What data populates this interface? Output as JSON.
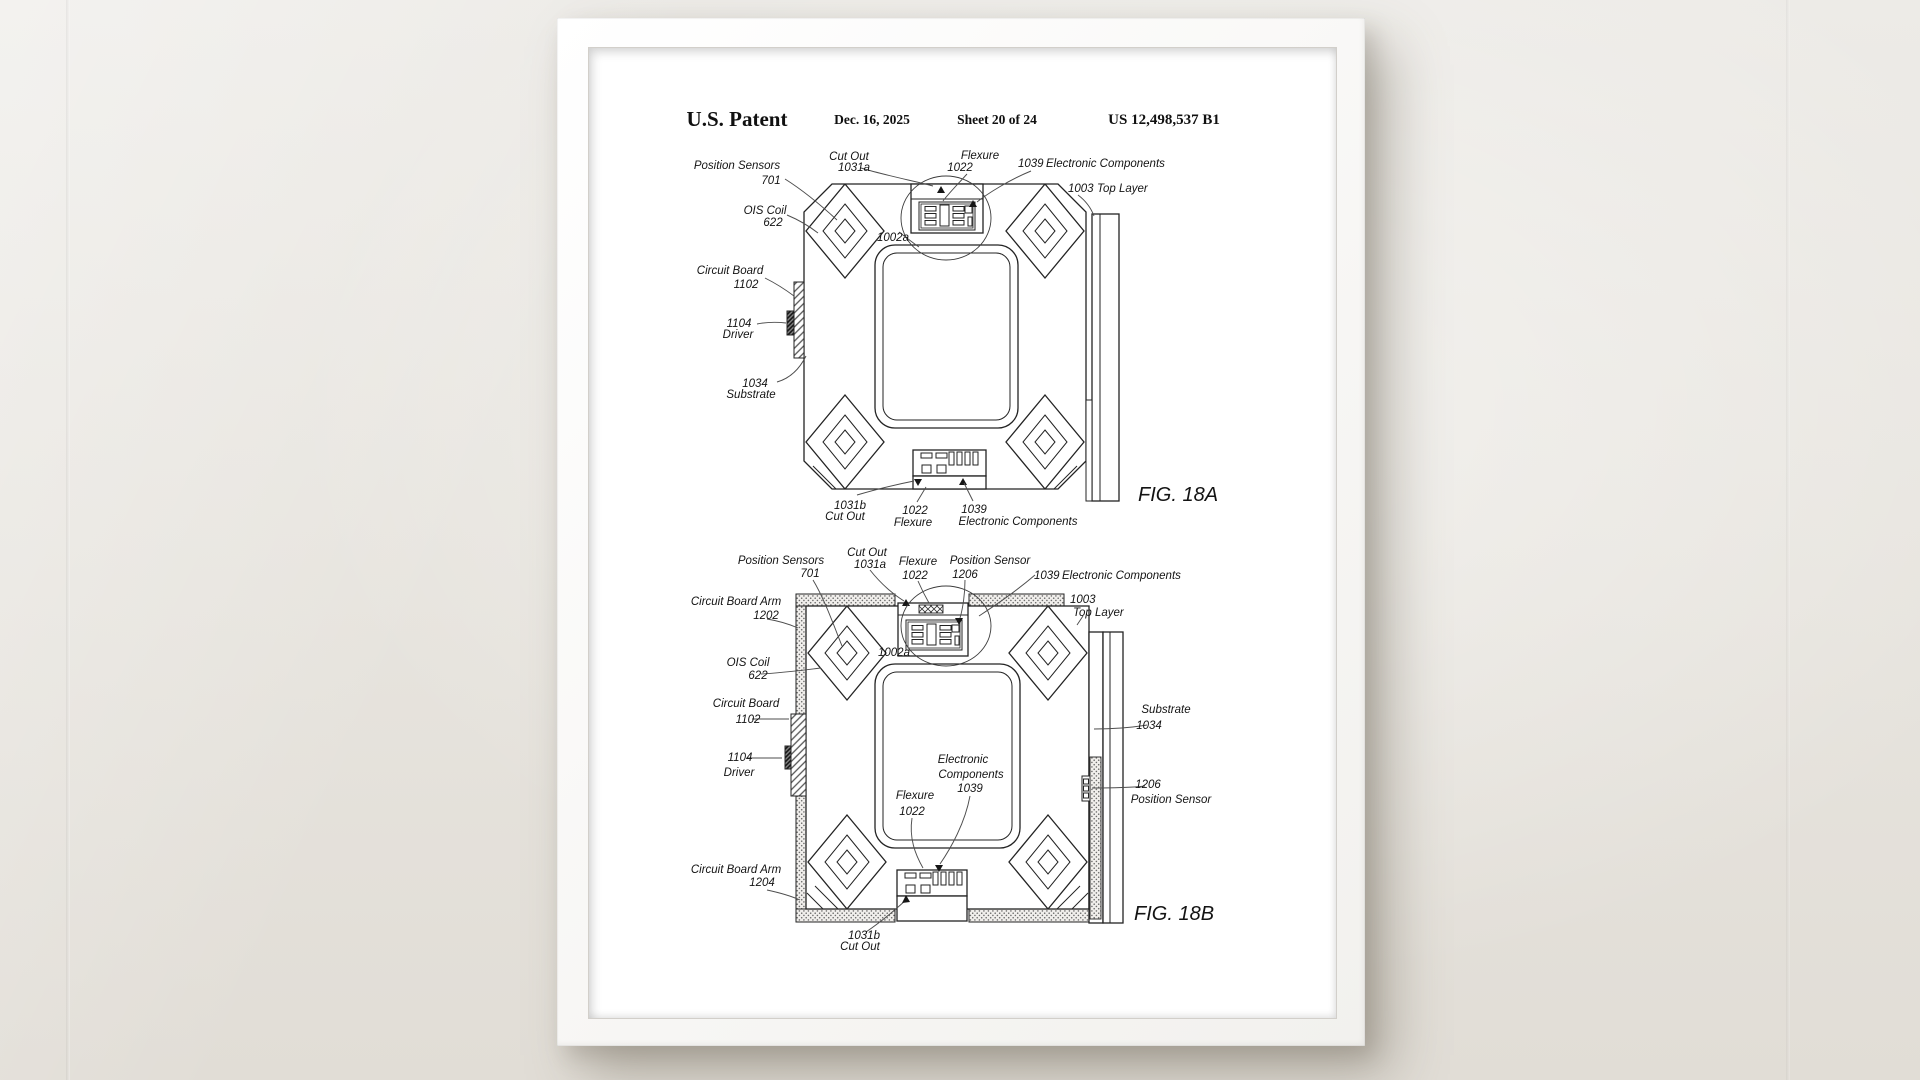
{
  "colors": {
    "wall": "#e8e5e0",
    "frame": "#f7f6f4",
    "paper": "#ffffff",
    "ink": "#141414"
  },
  "header": {
    "title": "U.S. Patent",
    "date": "Dec. 16, 2025",
    "sheet": "Sheet 20 of 24",
    "number": "US 12,498,537 B1"
  },
  "fig18a": {
    "caption": "FIG. 18A",
    "pos_sensors": "Position Sensors",
    "pos_sensors_num": "701",
    "ois_coil": "OIS Coil",
    "ois_coil_num": "622",
    "cut_out_top": "Cut Out",
    "cut_out_top_num": "1031a",
    "flexure_top": "Flexure",
    "flexure_top_num": "1022",
    "ec_num": "1039",
    "ec_label": "Electronic Components",
    "top_layer_num": "1003",
    "top_layer_label": "Top Layer",
    "circuit_board": "Circuit Board",
    "circuit_board_num": "1102",
    "driver_num": "1104",
    "driver": "Driver",
    "substrate_num": "1034",
    "substrate": "Substrate",
    "detail_ref": "1002a",
    "cut_out_bottom_num": "1031b",
    "cut_out_bottom": "Cut Out",
    "flexure_bottom_num": "1022",
    "flexure_bottom": "Flexure",
    "ec_bottom_num": "1039",
    "ec_bottom": "Electronic Components"
  },
  "fig18b": {
    "caption": "FIG. 18B",
    "pos_sensors": "Position Sensors",
    "pos_sensors_num": "701",
    "cut_out_top": "Cut Out",
    "cut_out_top_num": "1031a",
    "flexure_top": "Flexure",
    "flexure_top_num": "1022",
    "pos_sensor_top": "Position Sensor",
    "pos_sensor_top_num": "1206",
    "ec_num": "1039",
    "ec_label": "Electronic Components",
    "cb_arm_top": "Circuit Board Arm",
    "cb_arm_top_num": "1202",
    "top_layer_num": "1003",
    "top_layer_label": "Top Layer",
    "ois_coil": "OIS Coil",
    "ois_coil_num": "622",
    "circuit_board": "Circuit Board",
    "circuit_board_num": "1102",
    "driver_num": "1104",
    "driver": "Driver",
    "substrate": "Substrate",
    "substrate_num": "1034",
    "pos_sensor_right_num": "1206",
    "pos_sensor_right": "Position Sensor",
    "ec_center_1": "Electronic",
    "ec_center_2": "Components",
    "ec_center_num": "1039",
    "flexure_center": "Flexure",
    "flexure_center_num": "1022",
    "cb_arm_bottom": "Circuit Board Arm",
    "cb_arm_bottom_num": "1204",
    "cut_out_bottom_num": "1031b",
    "cut_out_bottom": "Cut Out",
    "detail_ref": "1002a"
  }
}
